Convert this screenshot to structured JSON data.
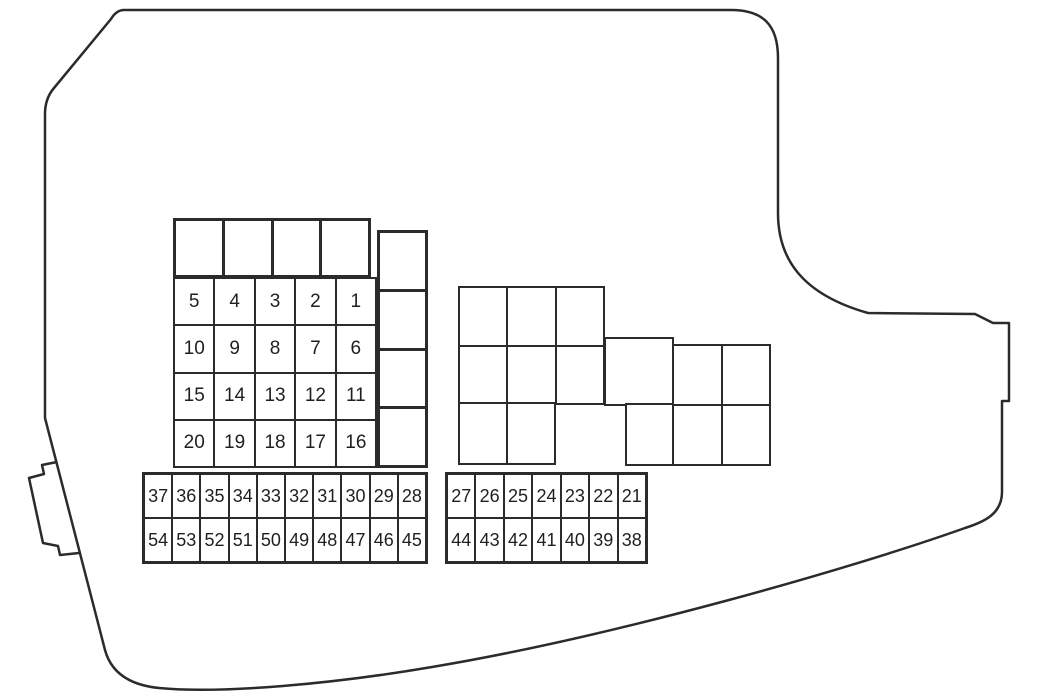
{
  "colors": {
    "line": "#2b2b2b",
    "background": "#ffffff",
    "text": "#1f1f1f"
  },
  "main_grid": {
    "rows": [
      [
        "5",
        "4",
        "3",
        "2",
        "1"
      ],
      [
        "10",
        "9",
        "8",
        "7",
        "6"
      ],
      [
        "15",
        "14",
        "13",
        "12",
        "11"
      ],
      [
        "20",
        "19",
        "18",
        "17",
        "16"
      ]
    ]
  },
  "strip_left": {
    "rows": [
      [
        "37",
        "36",
        "35",
        "34",
        "33",
        "32",
        "31",
        "30",
        "29",
        "28"
      ],
      [
        "54",
        "53",
        "52",
        "51",
        "50",
        "49",
        "48",
        "47",
        "46",
        "45"
      ]
    ]
  },
  "strip_right": {
    "rows": [
      [
        "27",
        "26",
        "25",
        "24",
        "23",
        "22",
        "21"
      ],
      [
        "44",
        "43",
        "42",
        "41",
        "40",
        "39",
        "38"
      ]
    ]
  }
}
